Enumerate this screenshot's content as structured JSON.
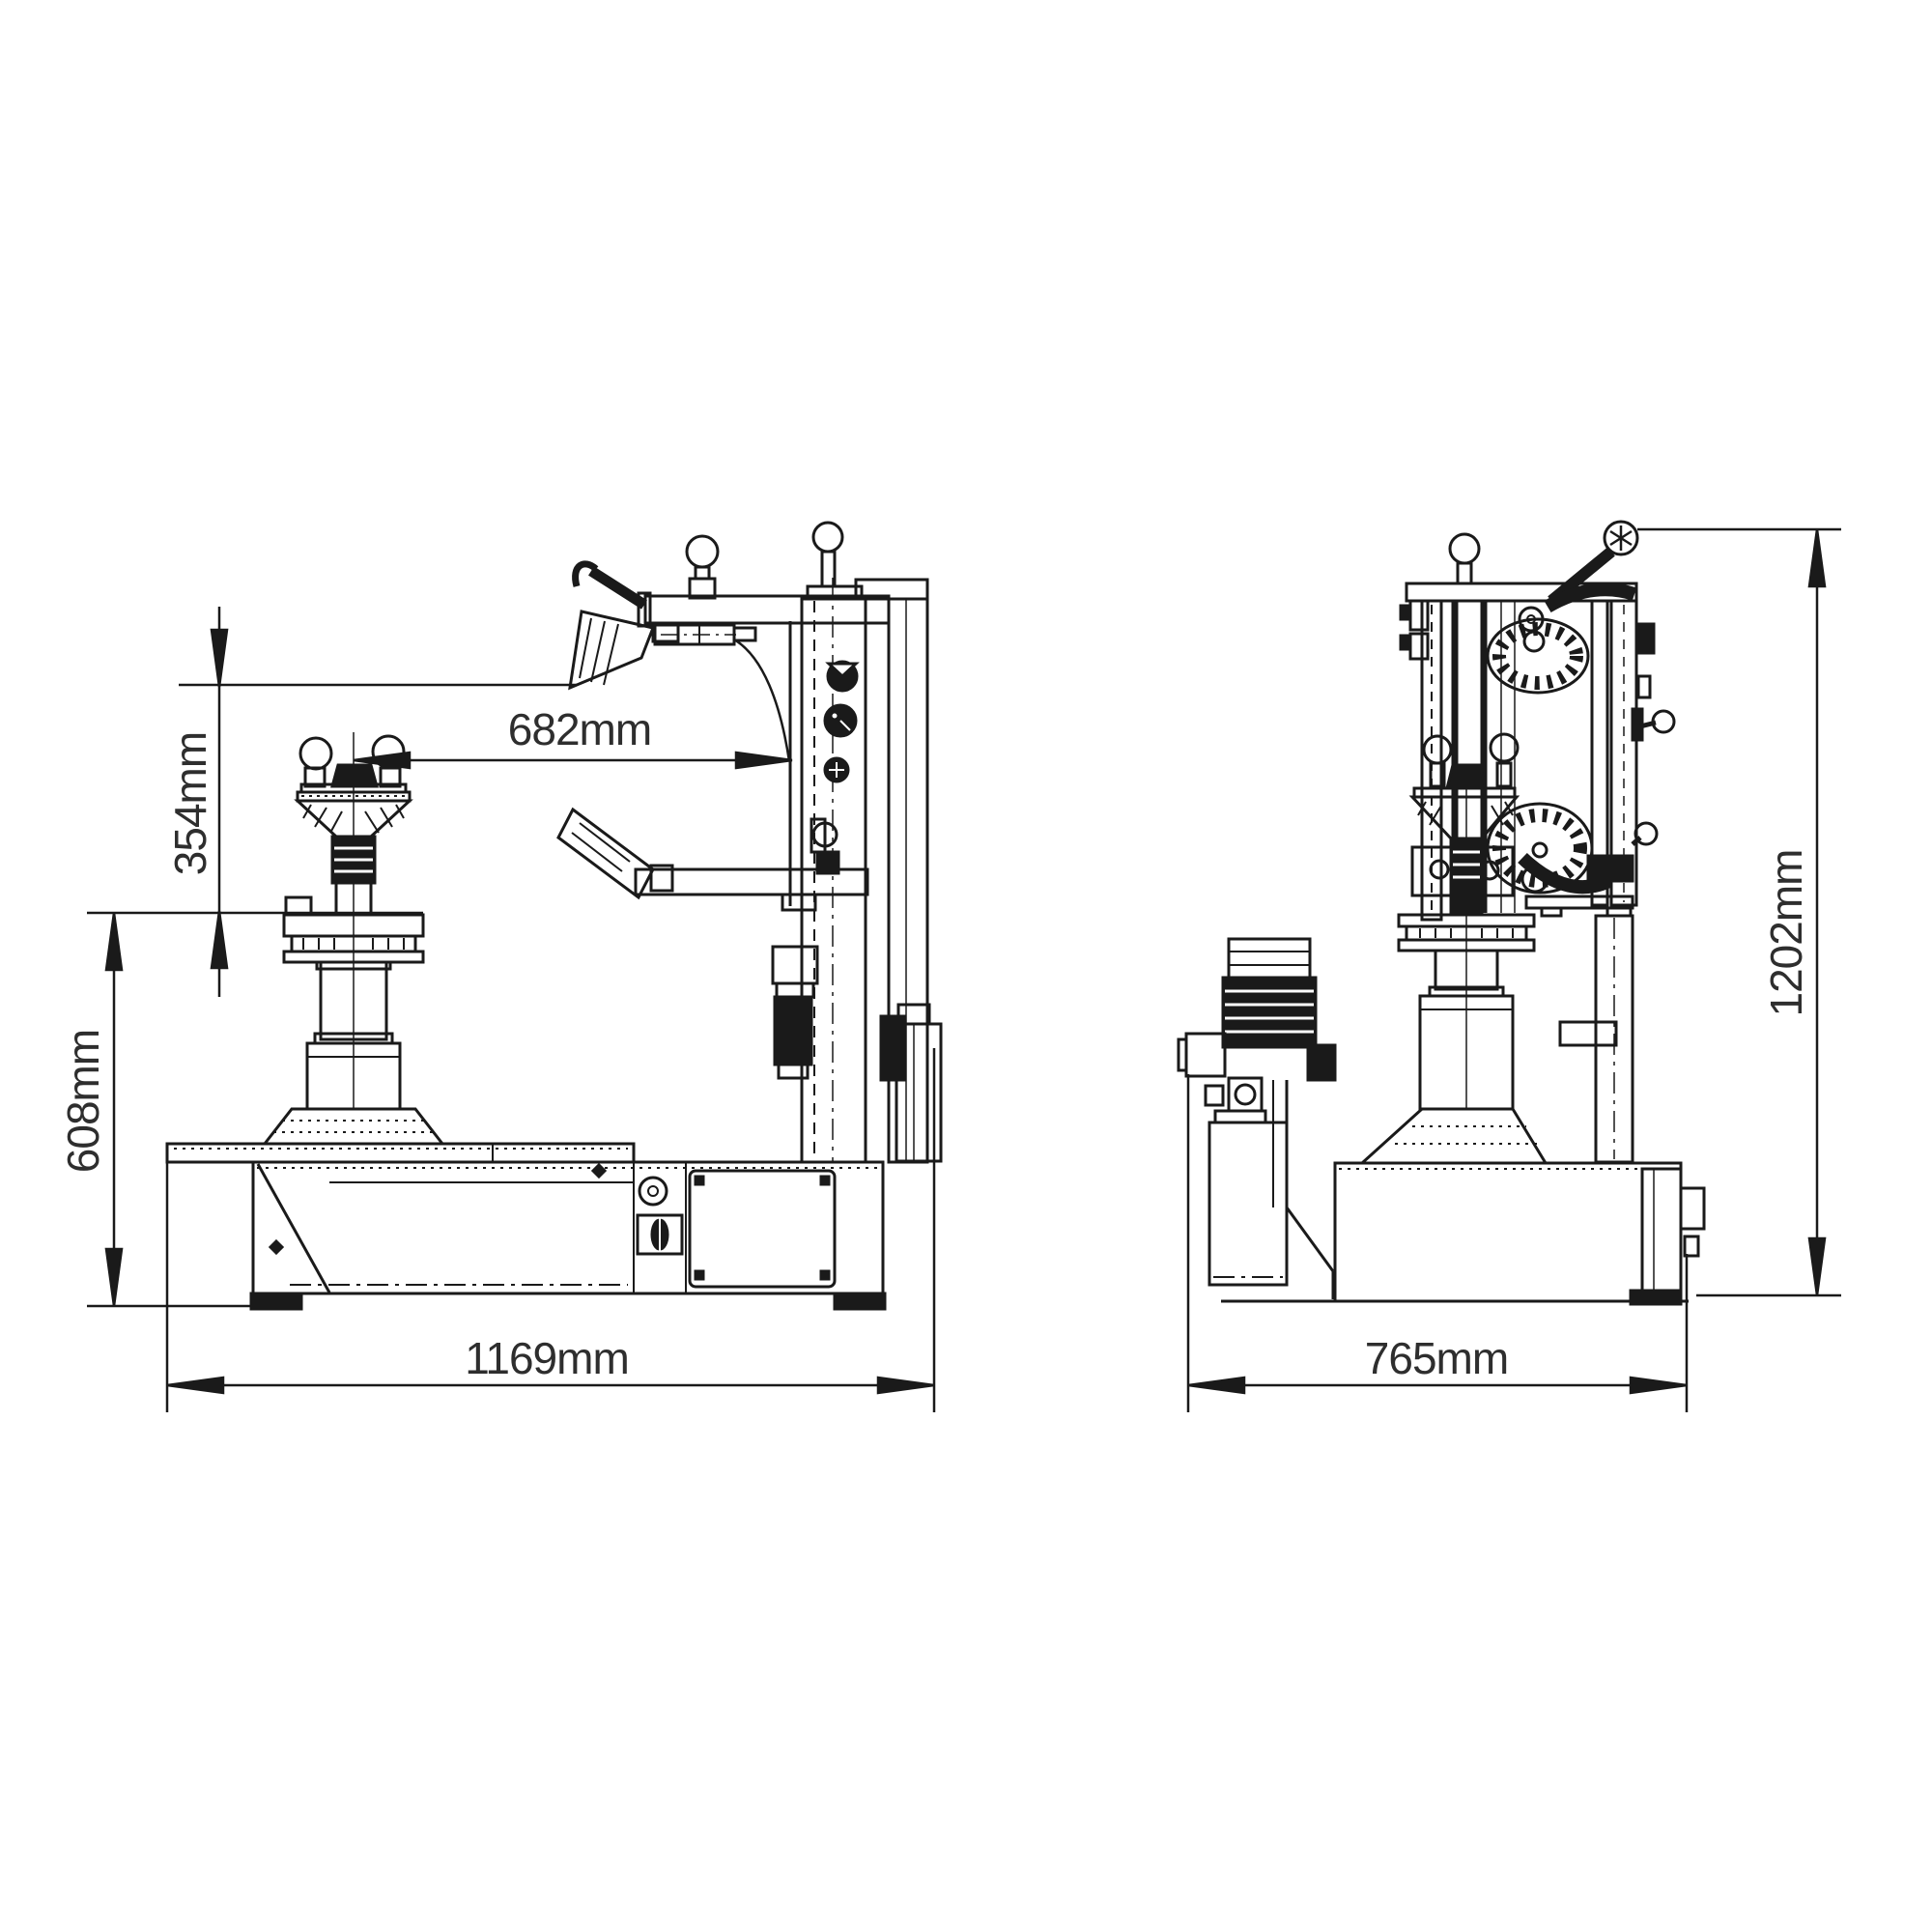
{
  "diagram": {
    "background_color": "#ffffff",
    "line_color": "#1a1a1a",
    "label_color": "#2e2e2e",
    "views": {
      "front": {
        "dimensions": {
          "arm_to_center": "682mm",
          "head_travel": "354mm",
          "table_height": "608mm",
          "overall_width": "1169mm"
        }
      },
      "side": {
        "dimensions": {
          "overall_depth": "765mm",
          "overall_height": "1202mm"
        }
      }
    }
  }
}
